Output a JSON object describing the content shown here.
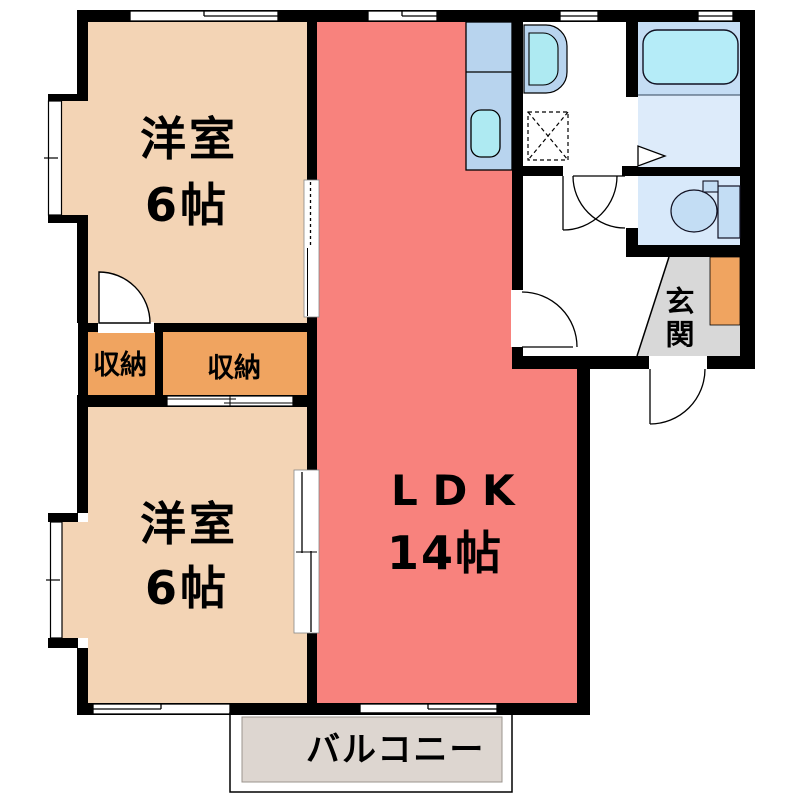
{
  "rooms": {
    "bedroom_top": {
      "label": "洋室",
      "size": "6帖"
    },
    "bedroom_bottom": {
      "label": "洋室",
      "size": "6帖"
    },
    "ldk": {
      "label": "LDK",
      "size": "14帖"
    },
    "closet_left": {
      "label": "収納"
    },
    "closet_right": {
      "label": "収納"
    },
    "entrance": {
      "label": "玄関"
    },
    "balcony": {
      "label": "バルコニー"
    }
  },
  "colors": {
    "wall": "#000000",
    "peach": "#f3d4b5",
    "salmon": "#f8827d",
    "orange": "#f0a460",
    "gray": "#d8d8d8",
    "balcony": "#ddd6d0",
    "bathfloor": "#ddebfa",
    "tubsurround": "#c5ddf4",
    "tub": "#b5ecf8",
    "toiletfloor": "#d8e9fa",
    "fixture": "#c3ddf4",
    "counter": "#b8d4ee",
    "sink": "#aeeaf2"
  }
}
